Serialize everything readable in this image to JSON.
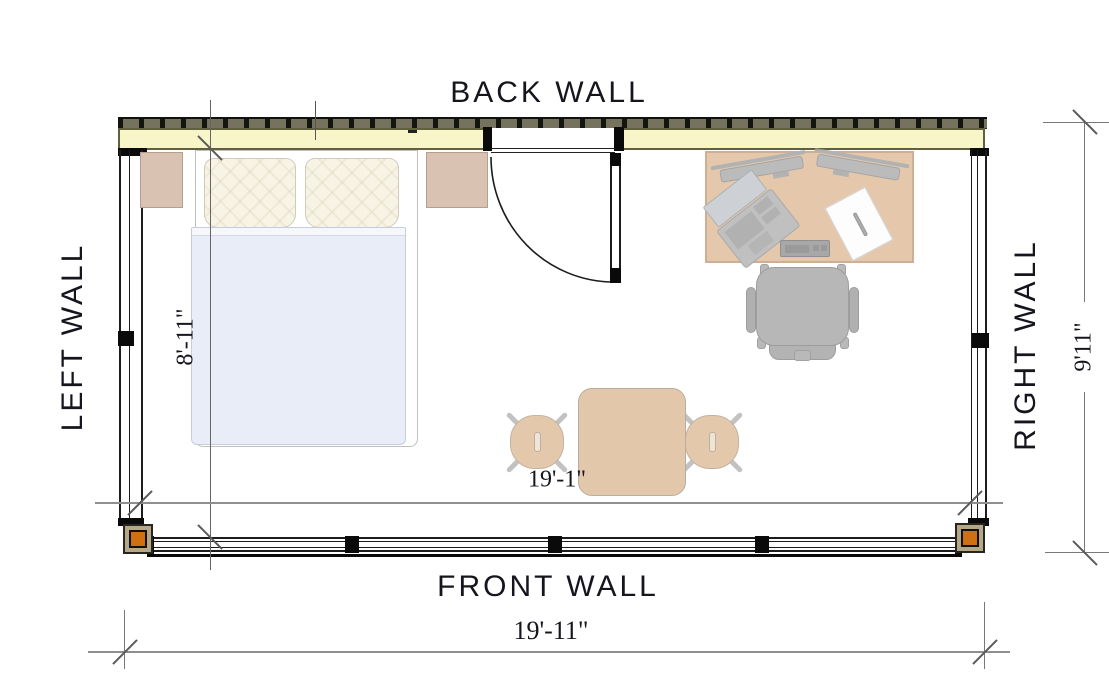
{
  "labels": {
    "back": "BACK WALL",
    "front": "FRONT WALL",
    "left": "LEFT WALL",
    "right": "RIGHT WALL"
  },
  "dimensions": {
    "room_depth_interior": "8'-11\"",
    "room_width_interior": "19'-1\"",
    "front_wall_overall": "19'-11\"",
    "right_wall_overall": "9'11\""
  },
  "colors": {
    "wall_yellow": "#f8f6c9",
    "wall_band_olive": "#75735e",
    "post_orange": "#cf7012",
    "post_ring_khaki": "#b5a888",
    "furniture_tan": "#e0bd9b",
    "nightstand_tan": "#d9c2b2",
    "table_tan": "#e0c1a2",
    "stool_tan": "#e2c3a4",
    "chair_gray": "#ababab",
    "blanket_blue": "#e9edf7",
    "pillow_cream": "#f7f4e6",
    "paper_white": "#fdfdfd",
    "line_black": "#1c1c1c",
    "dim_gray": "#8f8f8f"
  }
}
